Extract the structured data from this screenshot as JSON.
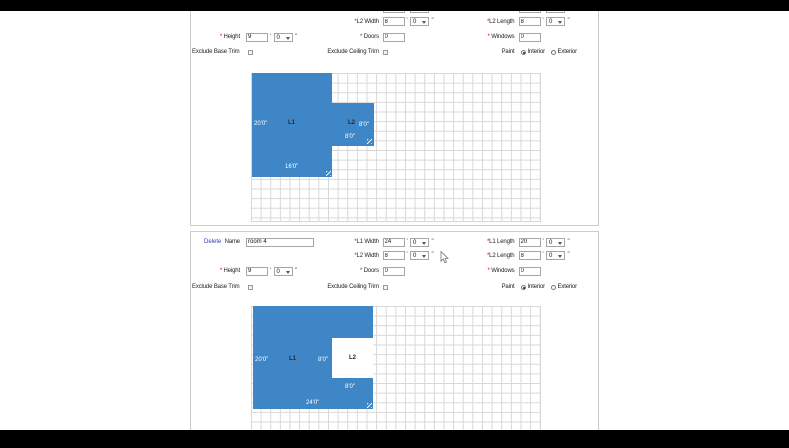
{
  "marks": {
    "star": "*",
    "feet": "'",
    "inch": "\""
  },
  "colors": {
    "room_fill": "#3e86c6",
    "delete_link": "#3a3ac0",
    "grid_line": "#d7d7d7"
  },
  "panel1": {
    "fields": {
      "l2_width": {
        "label": "L2 Width",
        "ft": "8",
        "in": "0"
      },
      "l2_length": {
        "label": "L2 Length",
        "ft": "8",
        "in": "0"
      },
      "height": {
        "label": "Height",
        "ft": "9",
        "in": "0"
      },
      "doors": {
        "label": "Doors",
        "value": "0"
      },
      "windows": {
        "label": "Windows",
        "value": "0"
      },
      "exclude_base_trim": {
        "label": "Exclude Base Trim",
        "checked": false
      },
      "exclude_ceiling_trim": {
        "label": "Exclude Ceiling Trim",
        "checked": false
      },
      "paint": {
        "label": "Paint",
        "options": [
          "Interior",
          "Exterior"
        ],
        "selected": "Interior"
      }
    },
    "diagram": {
      "l1_label": "L1",
      "l2_label": "L2",
      "l1_height_dim": "20'0\"",
      "l1_width_dim": "16'0\"",
      "l2_height_dim": "8'0\"",
      "l2_width_dim": "8'0\""
    }
  },
  "panel2": {
    "delete_label": "Delete",
    "name": {
      "label": "Name",
      "value": "room 4"
    },
    "fields": {
      "l1_width": {
        "label": "L1 Width",
        "ft": "24",
        "in": "0"
      },
      "l1_length": {
        "label": "L1 Length",
        "ft": "20",
        "in": "0"
      },
      "l2_width": {
        "label": "L2 Width",
        "ft": "8",
        "in": "0"
      },
      "l2_length": {
        "label": "L2 Length",
        "ft": "8",
        "in": "0"
      },
      "height": {
        "label": "Height",
        "ft": "9",
        "in": "0"
      },
      "doors": {
        "label": "Doors",
        "value": "0"
      },
      "windows": {
        "label": "Windows",
        "value": "0"
      },
      "exclude_base_trim": {
        "label": "Exclude Base Trim",
        "checked": false
      },
      "exclude_ceiling_trim": {
        "label": "Exclude Ceiling Trim",
        "checked": false
      },
      "paint": {
        "label": "Paint",
        "options": [
          "Interior",
          "Exterior"
        ],
        "selected": "Interior"
      }
    },
    "diagram": {
      "l1_label": "L1",
      "l2_label": "L2",
      "l1_height_dim": "20'0\"",
      "l1_width_dim": "24'0\"",
      "l2_height_dim": "8'0\"",
      "l2_width_dim": "8'0\""
    }
  }
}
